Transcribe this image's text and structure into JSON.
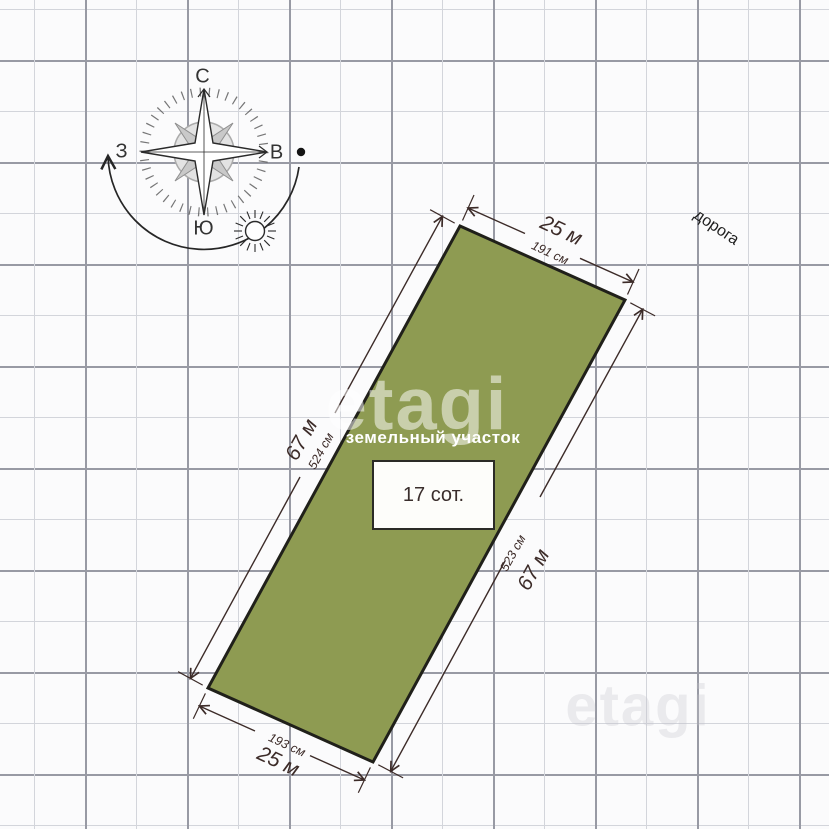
{
  "compass": {
    "north": "С",
    "south": "Ю",
    "west": "З",
    "east": "В"
  },
  "road_label": "дорога",
  "watermark": "etagi",
  "plot": {
    "name_label": "земельный участок",
    "area_label": "17 сот.",
    "fill_color": "#8e9b52",
    "dimensions": {
      "top": {
        "meters": "25 м",
        "cm": "191 см"
      },
      "bottom": {
        "meters": "25 м",
        "cm": "193 см"
      },
      "left": {
        "meters": "67 м",
        "cm": "524 см"
      },
      "right": {
        "meters": "67 м",
        "cm": "523 см"
      }
    }
  }
}
